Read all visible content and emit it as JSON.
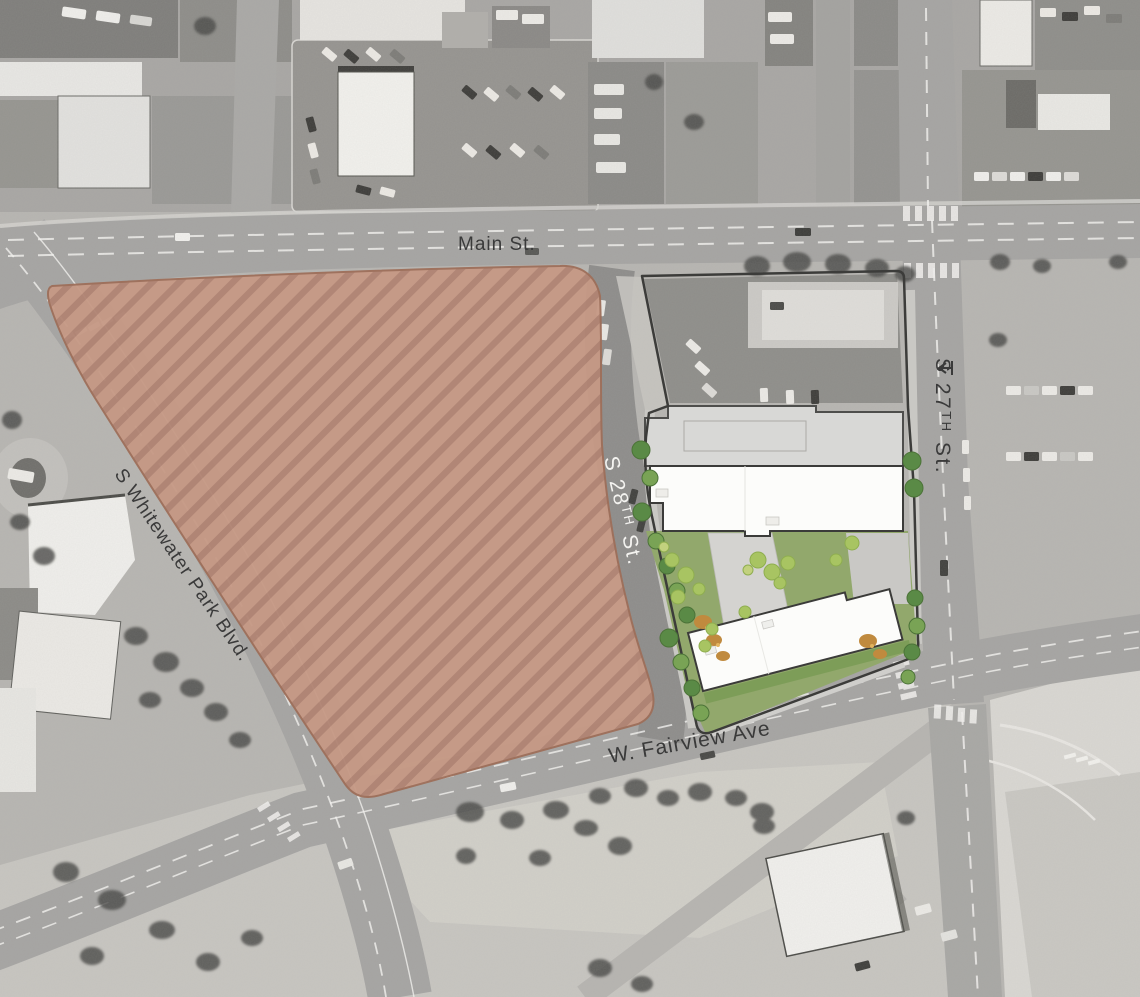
{
  "streets": {
    "main": {
      "label": "Main St."
    },
    "s27": {
      "pre": "S 27",
      "sup": "TH",
      "post": " St."
    },
    "s28": {
      "pre": "S 28",
      "sup": "TH",
      "post": " St."
    },
    "fairview": {
      "label": "W. Fairview Ave"
    },
    "whitewater": {
      "label": "S Whitewater Park Blvd."
    }
  },
  "colors": {
    "site-fill": "#c69985",
    "site-stripe": "#b18473",
    "site-border": "#9e6f5a",
    "lawn": "#92a86c",
    "tree-dark": "#5a8a46",
    "tree-mid": "#79a355",
    "tree-light": "#a8c462",
    "shrub-orange": "#c08a3e",
    "building-gray": "#d8d8d6",
    "building-white": "#fcfcfa",
    "plaza": "#d4d3d0",
    "road": "#a5a4a2",
    "street-dark": "#8d8c8a",
    "label-dark": "#3a3a3a",
    "label-light": "#f4f3f0"
  }
}
